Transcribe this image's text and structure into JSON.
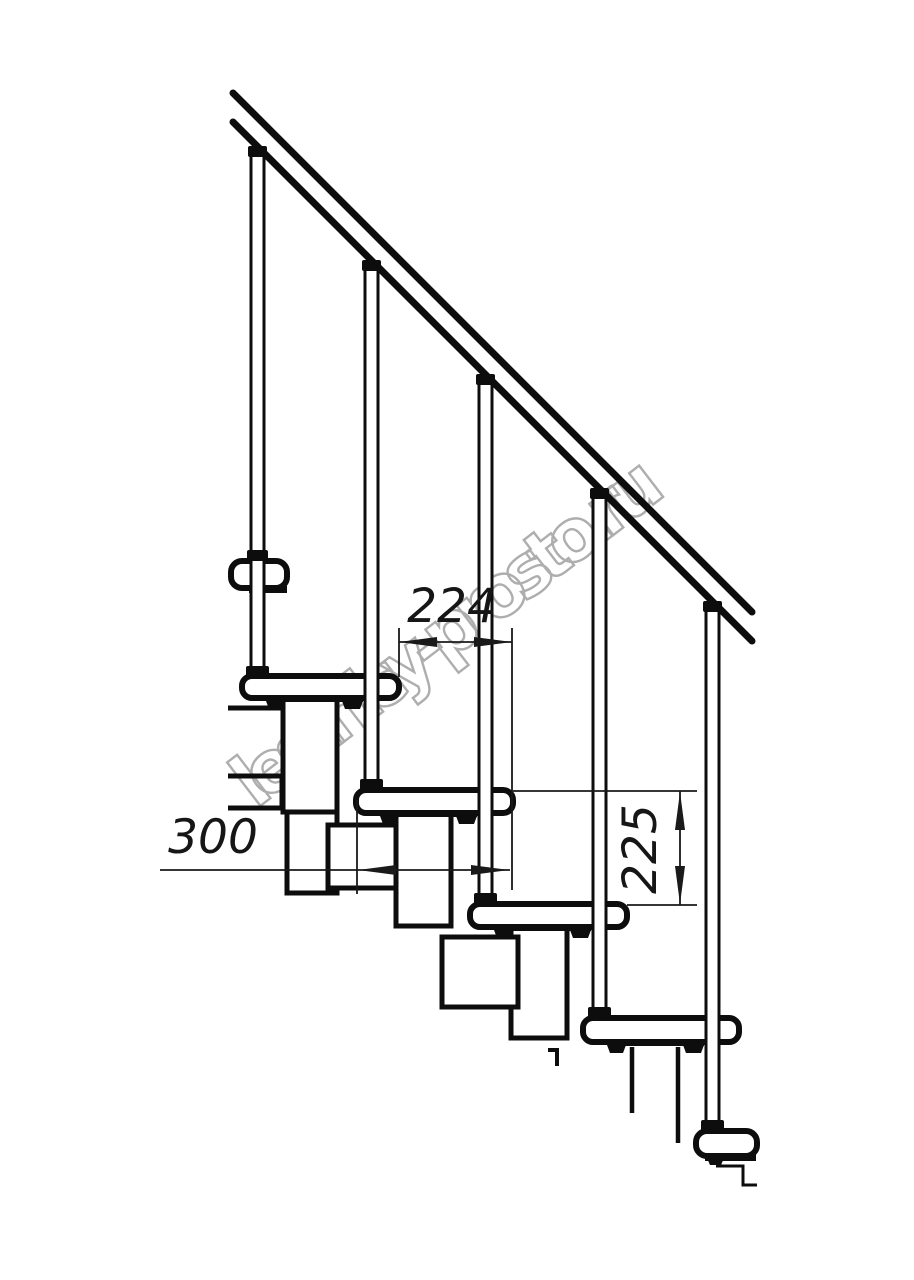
{
  "drawing": {
    "title": "modular staircase side-view technical drawing",
    "dimensions": {
      "run_224": "224",
      "depth_300": "300",
      "rise_225": "225"
    },
    "watermark": "lestnicy-prosto.ru",
    "colors": {
      "line": "#0d0d0d",
      "dimension_line": "#1a1a1a",
      "watermark_stroke": "#aeaeae",
      "background": "#ffffff"
    }
  }
}
